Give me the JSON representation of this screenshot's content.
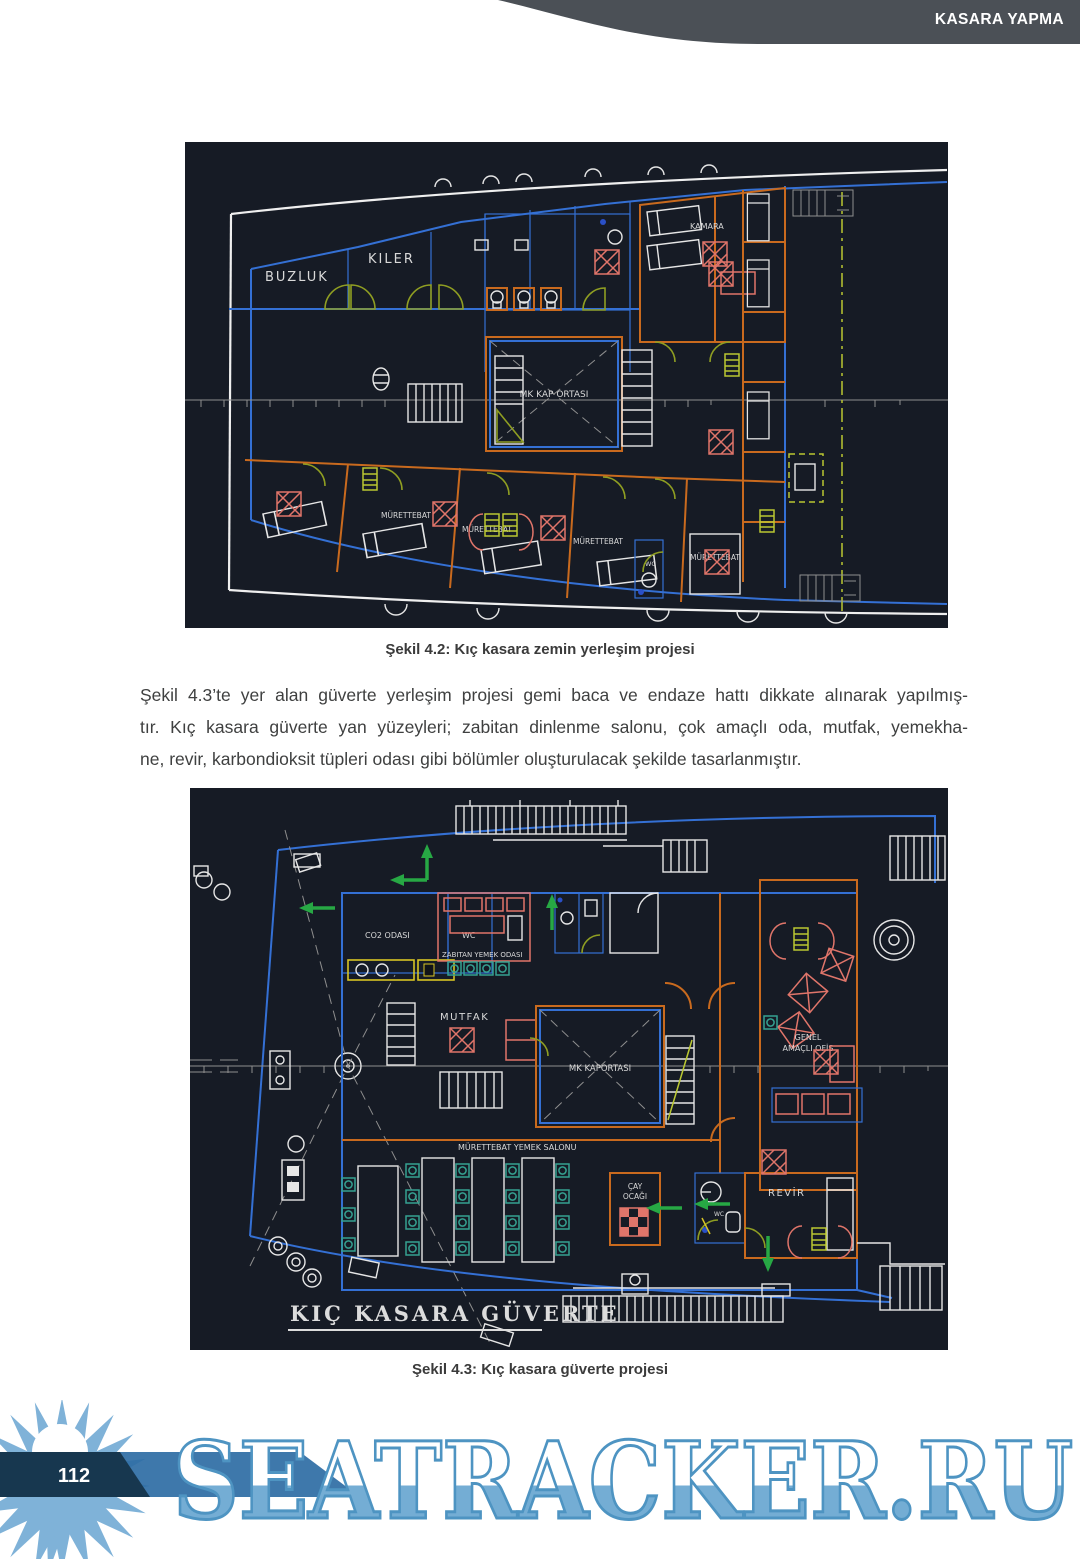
{
  "header": {
    "title": "KASARA YAPMA"
  },
  "figure1": {
    "caption": "Şekil 4.2: Kıç kasara zemin yerleşim projesi",
    "labels": {
      "buzluk": "BUZLUK",
      "kiler": "KILER",
      "kamara": "KAMARA",
      "mk_kap_ortasi": "MK KAP ORTASI",
      "murettebat": "MÜRETTEBAT",
      "wc": "WC"
    }
  },
  "paragraph": {
    "line1": "Şekil 4.3’te yer alan güverte yerleşim projesi gemi baca ve endaze hattı dikkate alınarak yapılmış-",
    "line2": "tır. Kıç kasara güverte yan yüzeyleri; zabitan dinlenme salonu, çok amaçlı oda, mutfak, yemekha-",
    "line3": "ne, revir, karbondioksit tüpleri odası gibi bölümler oluşturulacak şekilde tasarlanmıştır."
  },
  "figure2": {
    "caption": "Şekil 4.3: Kıç kasara güverte projesi",
    "labels": {
      "co2_odasi": "CO2 ODASI",
      "wc_top": "WC",
      "zabitan": "ZABITAN YEMEK ODASI",
      "mutfak": "MUTFAK",
      "mk_kaportasi": "MK KAPORTASI",
      "genel_line1": "GENEL",
      "genel_line2": "AMAÇLI OFİS",
      "murettebat_salon": "MÜRETTEBAT YEMEK SALONU",
      "cay_line1": "ÇAY",
      "cay_line2": "OCAĞI",
      "wc_small": "WC",
      "revir": "REVİR",
      "deck_title": "KIÇ KASARA GÜVERTE"
    }
  },
  "footer": {
    "page_number": "112",
    "watermark": "SEATRACKER.RU"
  },
  "colors": {
    "header_band": "#4b5056",
    "cad_background": "#161b25",
    "cad_blue": "#3470d4",
    "cad_orange": "#c96a1e",
    "cad_salmon": "#e0756a",
    "cad_olive": "#8f9e22",
    "cad_lime": "#bac832",
    "cad_teal": "#35a191",
    "cad_green": "#27a844",
    "watermark_blue": "#74add4",
    "banner_navy": "#17374f",
    "banner_blue": "#2e6da4"
  }
}
